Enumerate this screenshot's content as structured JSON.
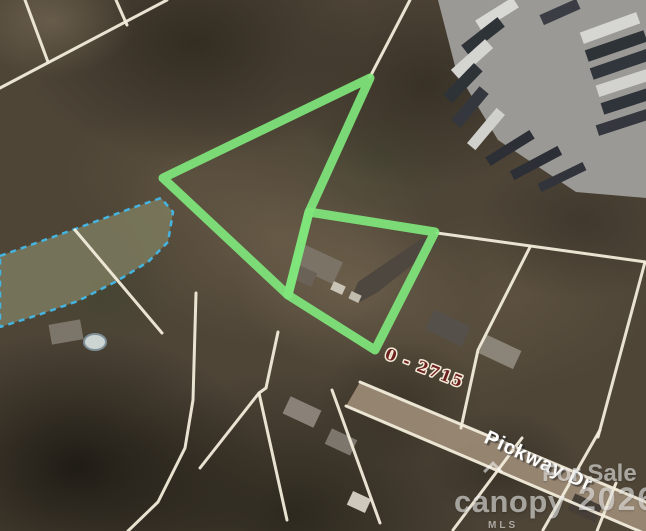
{
  "map": {
    "street_label": "Pickway Dr",
    "parcel_range_label": "0 - 2715",
    "watermark": {
      "for_sale": "For Sale",
      "year": "2026",
      "brand": "canopy",
      "mls": "MLS"
    },
    "colors": {
      "highlight_green": "#7fe67c",
      "parcel_line_white": "#f2ecdb",
      "water_outline_blue": "#45b4e0",
      "water_fill": "#7b7a5e",
      "range_label_red": "#6d2020",
      "street_label_white": "#ffffff",
      "yard_gray": "#9b9995",
      "road_tan": "#a1907a",
      "driveway_gray": "#4e473f"
    },
    "highlight_polygons": [
      [
        [
          370,
          78
        ],
        [
          163,
          178
        ],
        [
          288,
          295
        ],
        [
          309,
          212
        ]
      ],
      [
        [
          309,
          212
        ],
        [
          435,
          232
        ],
        [
          375,
          350
        ],
        [
          288,
          295
        ]
      ]
    ],
    "parcel_lines": [
      [
        [
          167,
          0
        ],
        [
          0,
          88
        ]
      ],
      [
        [
          25,
          0
        ],
        [
          48,
          62
        ]
      ],
      [
        [
          116,
          0
        ],
        [
          127,
          25
        ]
      ],
      [
        [
          410,
          0
        ],
        [
          370,
          77
        ]
      ],
      [
        [
          437,
          233
        ],
        [
          646,
          262
        ]
      ],
      [
        [
          530,
          247
        ],
        [
          478,
          350
        ],
        [
          461,
          428
        ]
      ],
      [
        [
          645,
          262
        ],
        [
          598,
          437
        ]
      ],
      [
        [
          75,
          230
        ],
        [
          162,
          333
        ]
      ],
      [
        [
          196,
          293
        ],
        [
          193,
          400
        ],
        [
          185,
          448
        ],
        [
          158,
          502
        ],
        [
          128,
          531
        ]
      ],
      [
        [
          278,
          332
        ],
        [
          266,
          388
        ],
        [
          259,
          393
        ],
        [
          287,
          520
        ]
      ],
      [
        [
          259,
          393
        ],
        [
          200,
          468
        ]
      ],
      [
        [
          332,
          390
        ],
        [
          380,
          523
        ]
      ],
      [
        [
          522,
          438
        ],
        [
          453,
          530
        ]
      ],
      [
        [
          600,
          430
        ],
        [
          543,
          530
        ]
      ],
      [
        [
          616,
          483
        ],
        [
          597,
          531
        ]
      ],
      [
        [
          360,
          382
        ],
        [
          646,
          502
        ]
      ],
      [
        [
          346,
          406
        ],
        [
          646,
          534
        ]
      ]
    ],
    "pond_points": [
      [
        0,
        256
      ],
      [
        78,
        228
      ],
      [
        135,
        207
      ],
      [
        161,
        198
      ],
      [
        173,
        212
      ],
      [
        168,
        242
      ],
      [
        148,
        262
      ],
      [
        117,
        281
      ],
      [
        78,
        301
      ],
      [
        38,
        315
      ],
      [
        0,
        327
      ]
    ],
    "road_points": [
      [
        360,
        382
      ],
      [
        646,
        502
      ],
      [
        646,
        534
      ],
      [
        346,
        406
      ]
    ],
    "yard_points": [
      [
        438,
        0
      ],
      [
        646,
        0
      ],
      [
        646,
        198
      ],
      [
        576,
        192
      ],
      [
        498,
        140
      ],
      [
        456,
        70
      ]
    ],
    "containers": [
      [
        497,
        14,
        44,
        12,
        -32,
        "#d8d8d4"
      ],
      [
        483,
        36,
        46,
        12,
        -38,
        "#2e3338"
      ],
      [
        472,
        59,
        46,
        12,
        -42,
        "#d4d4d0"
      ],
      [
        463,
        83,
        44,
        12,
        -46,
        "#2e3338"
      ],
      [
        470,
        107,
        44,
        12,
        -50,
        "#34383e"
      ],
      [
        486,
        129,
        46,
        11,
        -50,
        "#d0d0cc"
      ],
      [
        510,
        148,
        52,
        10,
        -32,
        "#2c3036"
      ],
      [
        536,
        163,
        54,
        10,
        -28,
        "#2c3036"
      ],
      [
        562,
        177,
        50,
        9,
        -26,
        "#31353b"
      ],
      [
        560,
        12,
        40,
        11,
        -24,
        "#3a3e44"
      ],
      [
        610,
        28,
        60,
        12,
        -20,
        "#d6d6d2"
      ],
      [
        616,
        46,
        62,
        12,
        -19,
        "#2e3338"
      ],
      [
        621,
        64,
        62,
        12,
        -19,
        "#31363c"
      ],
      [
        626,
        82,
        60,
        12,
        -18,
        "#d2d2ce"
      ],
      [
        630,
        100,
        58,
        12,
        -18,
        "#2f343a"
      ],
      [
        624,
        122,
        56,
        11,
        -18,
        "#34383e"
      ]
    ],
    "houses": [
      [
        318,
        264,
        44,
        24,
        25,
        "#7b7366"
      ],
      [
        305,
        276,
        20,
        15,
        25,
        "#6a6257"
      ],
      [
        338,
        288,
        13,
        9,
        25,
        "#cac4b6"
      ],
      [
        355,
        297,
        11,
        8,
        25,
        "#c2bcae"
      ],
      [
        448,
        328,
        40,
        22,
        25,
        "#55504a"
      ],
      [
        500,
        352,
        38,
        20,
        25,
        "#8b8478"
      ],
      [
        302,
        412,
        34,
        19,
        25,
        "#8a8278"
      ],
      [
        341,
        442,
        28,
        17,
        25,
        "#7d766c"
      ],
      [
        359,
        502,
        20,
        15,
        25,
        "#cfc9bd"
      ],
      [
        66,
        332,
        32,
        20,
        -10,
        "#7c756a"
      ],
      [
        585,
        508,
        30,
        18,
        25,
        "#453f38"
      ]
    ],
    "driveway_points": [
      [
        352,
        296
      ],
      [
        358,
        282
      ],
      [
        424,
        237
      ],
      [
        437,
        245
      ],
      [
        378,
        292
      ],
      [
        360,
        302
      ]
    ],
    "pool": {
      "cx": 95,
      "cy": 342,
      "rx": 11,
      "ry": 8
    }
  }
}
